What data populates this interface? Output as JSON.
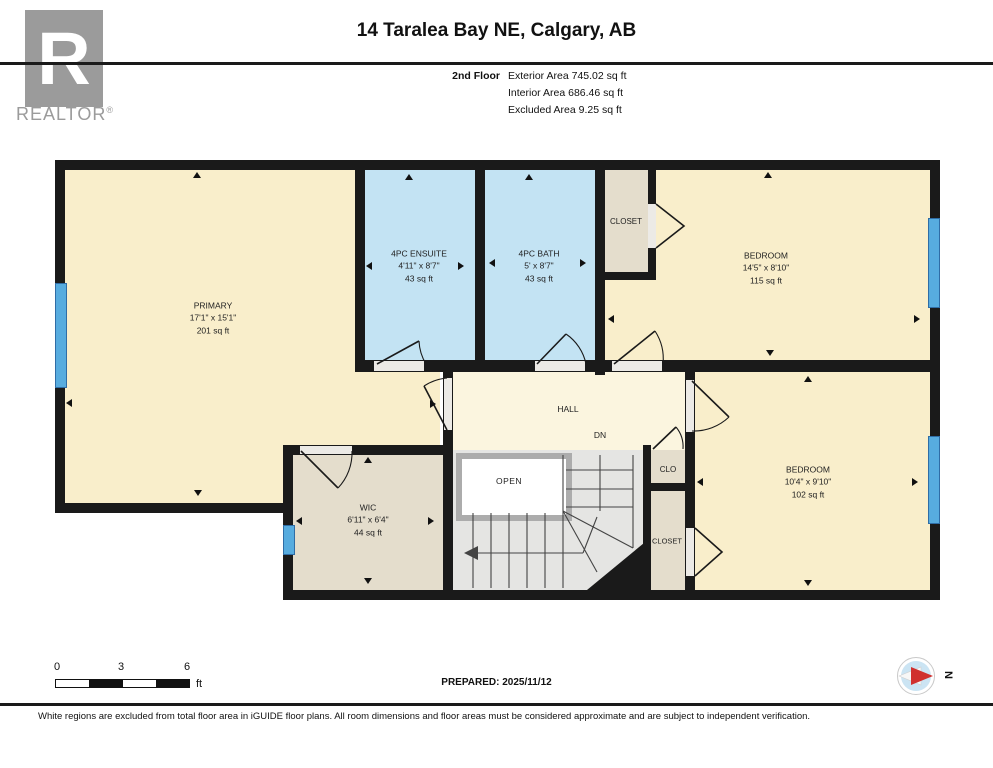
{
  "header": {
    "title": "14 Taralea Bay NE, Calgary, AB",
    "floor": "2nd Floor",
    "exterior": "Exterior Area 745.02 sq ft",
    "interior": "Interior Area 686.46 sq ft",
    "excluded": "Excluded Area 9.25 sq ft"
  },
  "logo": {
    "letter": "R",
    "text": "REALTOR",
    "reg": "®"
  },
  "rooms": {
    "primary": {
      "name": "PRIMARY",
      "dims": "17'1\" x 15'1\"",
      "area": "201 sq ft"
    },
    "ensuite": {
      "name": "4PC ENSUITE",
      "dims": "4'11\" x 8'7\"",
      "area": "43 sq ft"
    },
    "bath": {
      "name": "4PC BATH",
      "dims": "5' x 8'7\"",
      "area": "43 sq ft"
    },
    "closet_top": {
      "name": "CLOSET"
    },
    "bedroom_top": {
      "name": "BEDROOM",
      "dims": "14'5\" x 8'10\"",
      "area": "115 sq ft"
    },
    "hall": {
      "name": "HALL"
    },
    "dn": {
      "label": "DN"
    },
    "open": {
      "label": "OPEN"
    },
    "wic": {
      "name": "WIC",
      "dims": "6'11\" x 6'4\"",
      "area": "44 sq ft"
    },
    "clo": {
      "name": "CLO"
    },
    "closet_bottom": {
      "name": "CLOSET"
    },
    "bedroom_bottom": {
      "name": "BEDROOM",
      "dims": "10'4\" x 9'10\"",
      "area": "102 sq ft"
    }
  },
  "footer": {
    "scale_ticks": [
      "0",
      "3",
      "6"
    ],
    "scale_unit": "ft",
    "prepared": "PREPARED: 2025/11/12",
    "compass_n": "N",
    "disclaimer": "White regions are excluded from total floor area in iGUIDE floor plans. All room dimensions and floor areas must be considered approximate and are subject to independent verification."
  },
  "colors": {
    "room_fill": "#F9EECB",
    "bath_fill": "#C3E3F3",
    "closet_fill": "#E4DDCC",
    "hall_fill": "#FBF5DF",
    "stair_fill": "#E5E5E3",
    "window_blue": "#57ACDF",
    "wall": "#1A1A1A",
    "compass_red": "#D0302E",
    "logo_gray": "#9B9B9B"
  }
}
